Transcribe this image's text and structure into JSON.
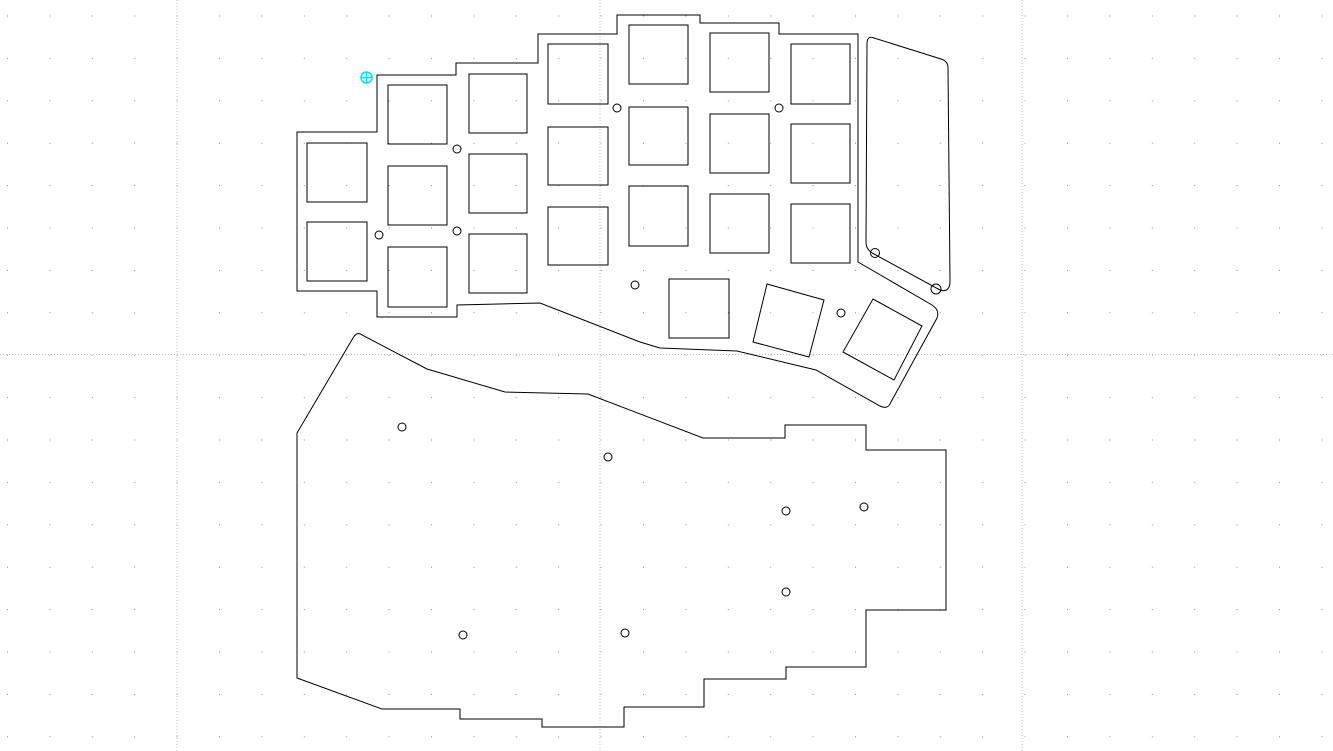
{
  "canvas": {
    "width": 1333,
    "height": 751,
    "background": "#ffffff",
    "stroke_color": "#000000",
    "stroke_width": 1
  },
  "grid": {
    "dot_spacing": 42.4,
    "dot_offset_x": 7,
    "dot_offset_y": 15.5,
    "dot_color": "#8a8a8a",
    "major_line_color": "#c3c3c3",
    "major_dash": "1 2",
    "major_vlines": [
      177,
      600,
      1022
    ],
    "major_hlines": [
      354.5
    ]
  },
  "origin_marker": {
    "cx": 366.5,
    "cy": 77.5,
    "r": 5.5,
    "color": "#00e6ea"
  },
  "pieces": {
    "switch_plate": {
      "outline": "M 297,132 L 377,132 L 377,75 L 456,75 L 456,63 L 538,63 L 538,34 L 617,34 L 617,15 L 700,15 L 700,23 L 779,23 L 779,34 L 858,34 L 858,262 L 932,305 Q 940,310 937,318 L 891,402 Q 888,410 880,406 L 816,370 L 737,351 L 660,348 L 640,342 L 540,303 L 457,305 L 457,317 L 377,317 L 377,291 L 297,291 Z",
      "cutouts": [
        {
          "x": 307,
          "y": 143,
          "w": 60,
          "h": 59
        },
        {
          "x": 307,
          "y": 222,
          "w": 60,
          "h": 59
        },
        {
          "x": 388,
          "y": 85,
          "w": 59,
          "h": 59
        },
        {
          "x": 388,
          "y": 166,
          "w": 59,
          "h": 59
        },
        {
          "x": 388,
          "y": 247,
          "w": 59,
          "h": 60
        },
        {
          "x": 469,
          "y": 74,
          "w": 58,
          "h": 59
        },
        {
          "x": 469,
          "y": 154,
          "w": 58,
          "h": 59
        },
        {
          "x": 469,
          "y": 234,
          "w": 58,
          "h": 59
        },
        {
          "x": 548,
          "y": 44,
          "w": 60,
          "h": 60
        },
        {
          "x": 548,
          "y": 127,
          "w": 60,
          "h": 58
        },
        {
          "x": 548,
          "y": 207,
          "w": 60,
          "h": 58
        },
        {
          "x": 629,
          "y": 25,
          "w": 59,
          "h": 59
        },
        {
          "x": 629,
          "y": 107,
          "w": 59,
          "h": 58
        },
        {
          "x": 629,
          "y": 186,
          "w": 59,
          "h": 60
        },
        {
          "x": 710,
          "y": 33,
          "w": 59,
          "h": 59
        },
        {
          "x": 710,
          "y": 114,
          "w": 59,
          "h": 59
        },
        {
          "x": 710,
          "y": 194,
          "w": 59,
          "h": 59
        },
        {
          "x": 791,
          "y": 44,
          "w": 59,
          "h": 60
        },
        {
          "x": 791,
          "y": 124,
          "w": 59,
          "h": 59
        },
        {
          "x": 791,
          "y": 204,
          "w": 59,
          "h": 59
        },
        {
          "x": 669,
          "y": 279,
          "w": 60,
          "h": 59
        }
      ],
      "rotated_cutouts": [
        {
          "points": "767,284 824,300 809,357 753,342"
        },
        {
          "points": "873,299 922,326 894,380 843,352"
        }
      ],
      "holes": [
        {
          "cx": 457,
          "cy": 149,
          "r": 4
        },
        {
          "cx": 379,
          "cy": 235,
          "r": 4
        },
        {
          "cx": 457,
          "cy": 231,
          "r": 4
        },
        {
          "cx": 617,
          "cy": 108,
          "r": 4
        },
        {
          "cx": 779,
          "cy": 108,
          "r": 4
        },
        {
          "cx": 635,
          "cy": 285,
          "r": 4
        },
        {
          "cx": 841,
          "cy": 313,
          "r": 4
        }
      ]
    },
    "right_plate": {
      "outline": "M 874,38 L 941,59 Q 948,61 948,68 L 950,281 Q 950,293 940,290 L 874,254 Q 866,250 866,242 L 867,44 Q 867,35 874,38 Z",
      "holes": [
        {
          "cx": 875,
          "cy": 253,
          "r": 4.5
        },
        {
          "cx": 936,
          "cy": 289,
          "r": 5
        }
      ]
    },
    "bottom_plate": {
      "outline": "M 353,338 Q 357,331 362,335 L 427,369 L 505,392 L 588,394 L 703,438 L 785,438 L 785,425 L 866,425 L 866,450 L 946,450 L 946,610 L 866,610 L 866,667 L 786,667 L 786,679 L 704,679 L 704,707 L 624,707 L 624,727 L 542,727 L 542,719 L 460,719 L 460,709 L 382,709 L 297,678 L 297,433 Z",
      "holes": [
        {
          "cx": 402,
          "cy": 427,
          "r": 4
        },
        {
          "cx": 608,
          "cy": 457,
          "r": 4
        },
        {
          "cx": 786,
          "cy": 511,
          "r": 4
        },
        {
          "cx": 864,
          "cy": 507,
          "r": 4
        },
        {
          "cx": 786,
          "cy": 592,
          "r": 4
        },
        {
          "cx": 463,
          "cy": 635,
          "r": 4
        },
        {
          "cx": 625,
          "cy": 633,
          "r": 4
        }
      ]
    }
  }
}
